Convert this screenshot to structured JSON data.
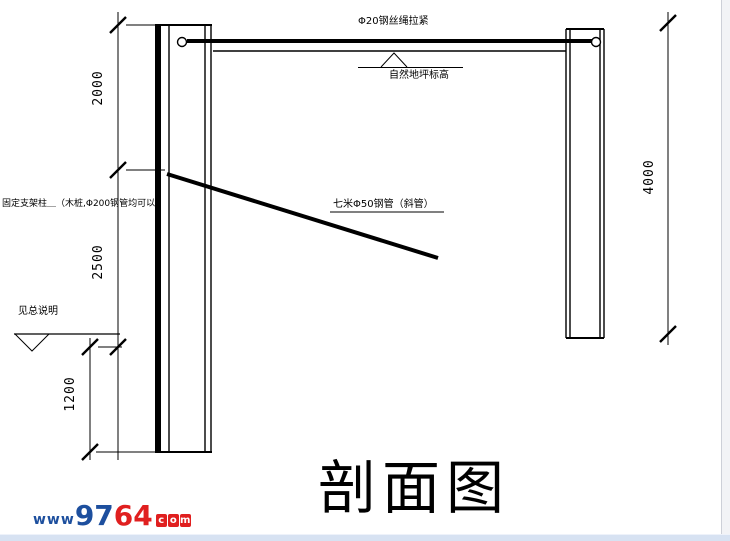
{
  "drawing": {
    "title": "剖面图",
    "labels": {
      "wire_rope": "Φ20钢丝绳拉紧",
      "top_elevation": "自然地坪标高",
      "diagonal_brace": "七米Φ50钢管（斜管）",
      "post_note": "固定支架柱＿（木桩,Φ200钢管均可以）",
      "ground_note": "见总说明"
    },
    "dimensions": {
      "left_upper": "2000",
      "left_middle": "2500",
      "left_lower": "1200",
      "right": "4000"
    }
  },
  "watermark": {
    "prefix": "www",
    "digits_blue": "97",
    "digits_red": "64",
    "suffix": [
      "c",
      "o",
      "m"
    ]
  },
  "colors": {
    "line": "#000000",
    "watermark_blue": "#1d4f9e",
    "watermark_red": "#e01f1f",
    "bottom_bar": "#d7e2f2",
    "right_gutter": "#f2f3f6"
  }
}
